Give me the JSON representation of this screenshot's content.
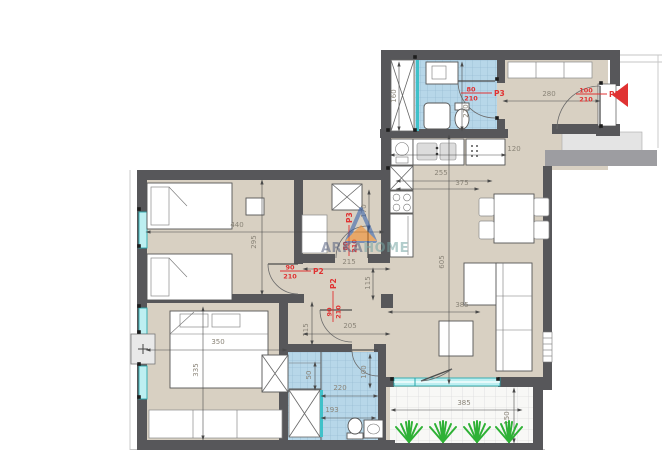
{
  "watermark": {
    "arka": "ARKA",
    "home": "HOME"
  },
  "door_labels": [
    {
      "width": "100",
      "height": "210",
      "tag": "P1",
      "x": 585,
      "y": 94,
      "rot": false
    },
    {
      "width": "80",
      "height": "210",
      "tag": "P3",
      "x": 470,
      "y": 93,
      "rot": false
    },
    {
      "width": "90",
      "height": "210",
      "tag": "P2",
      "x": 289,
      "y": 271,
      "rot": false
    },
    {
      "width": "90",
      "height": "210",
      "tag": "P2",
      "x": 333,
      "y": 313,
      "rot": true
    },
    {
      "width": "80",
      "height": "210",
      "tag": "P3",
      "x": 349,
      "y": 247,
      "rot": true
    }
  ],
  "dimensions": [
    {
      "v": "160",
      "x": 396,
      "y": 96,
      "rot": true,
      "line": [
        399,
        64,
        399,
        129
      ]
    },
    {
      "v": "280",
      "x": 549,
      "y": 96,
      "rot": false,
      "line": [
        505,
        101,
        598,
        101
      ]
    },
    {
      "v": "270",
      "x": 468,
      "y": 111,
      "rot": true,
      "line": [
        462,
        64,
        462,
        129
      ]
    },
    {
      "v": "120",
      "x": 514,
      "y": 151,
      "rot": false,
      "line": [
        392,
        155,
        504,
        155
      ]
    },
    {
      "v": "255",
      "x": 441,
      "y": 175,
      "rot": false,
      "line": [
        398,
        181,
        490,
        181
      ]
    },
    {
      "v": "375",
      "x": 462,
      "y": 185,
      "rot": false,
      "line": [
        398,
        189,
        477,
        189
      ]
    },
    {
      "v": "605",
      "x": 444,
      "y": 262,
      "rot": true,
      "line": [
        449,
        137,
        449,
        382
      ]
    },
    {
      "v": "215",
      "x": 349,
      "y": 264,
      "rot": false,
      "line": [
        305,
        269,
        388,
        269
      ]
    },
    {
      "v": "115",
      "x": 370,
      "y": 283,
      "rot": true,
      "line": [
        373,
        270,
        373,
        298
      ]
    },
    {
      "v": "170",
      "x": 366,
      "y": 211,
      "rot": true,
      "line": [
        369,
        192,
        369,
        228
      ]
    },
    {
      "v": "440",
      "x": 237,
      "y": 227,
      "rot": false,
      "line": [
        148,
        232,
        382,
        232
      ]
    },
    {
      "v": "295",
      "x": 256,
      "y": 242,
      "rot": true,
      "line": [
        262,
        182,
        262,
        293
      ]
    },
    {
      "v": "350",
      "x": 218,
      "y": 344,
      "rot": false,
      "line": [
        148,
        350,
        285,
        350
      ]
    },
    {
      "v": "335",
      "x": 198,
      "y": 370,
      "rot": true,
      "line": [
        203,
        309,
        203,
        438
      ]
    },
    {
      "v": "115",
      "x": 308,
      "y": 330,
      "rot": true,
      "line": [
        312,
        304,
        312,
        343
      ]
    },
    {
      "v": "205",
      "x": 350,
      "y": 328,
      "rot": false,
      "line": [
        305,
        334,
        388,
        334
      ]
    },
    {
      "v": "220",
      "x": 340,
      "y": 390,
      "rot": false,
      "line": [
        323,
        396,
        376,
        396
      ]
    },
    {
      "v": "50",
      "x": 311,
      "y": 375,
      "rot": true,
      "line": [
        315,
        364,
        315,
        388
      ]
    },
    {
      "v": "100",
      "x": 366,
      "y": 372,
      "rot": true,
      "line": [
        370,
        356,
        370,
        386
      ]
    },
    {
      "v": "193",
      "x": 332,
      "y": 412,
      "rot": false,
      "line": [
        323,
        418,
        374,
        418
      ]
    },
    {
      "v": "385",
      "x": 462,
      "y": 307,
      "rot": false,
      "line": [
        390,
        312,
        478,
        312
      ]
    },
    {
      "v": "385",
      "x": 464,
      "y": 405,
      "rot": false,
      "line": [
        393,
        410,
        520,
        410
      ]
    },
    {
      "v": "150",
      "x": 509,
      "y": 418,
      "rot": true,
      "line": [
        514,
        390,
        514,
        441
      ]
    }
  ],
  "colors": {
    "wall": "#57575a",
    "floor": "#d8d0c2",
    "bath_tile": "#b7d7e9",
    "window_glass": "#3fc1c9",
    "door_label_red": "#e03232",
    "plant_green": "#2eb135",
    "balcony_tile": "#f8f8f6"
  }
}
